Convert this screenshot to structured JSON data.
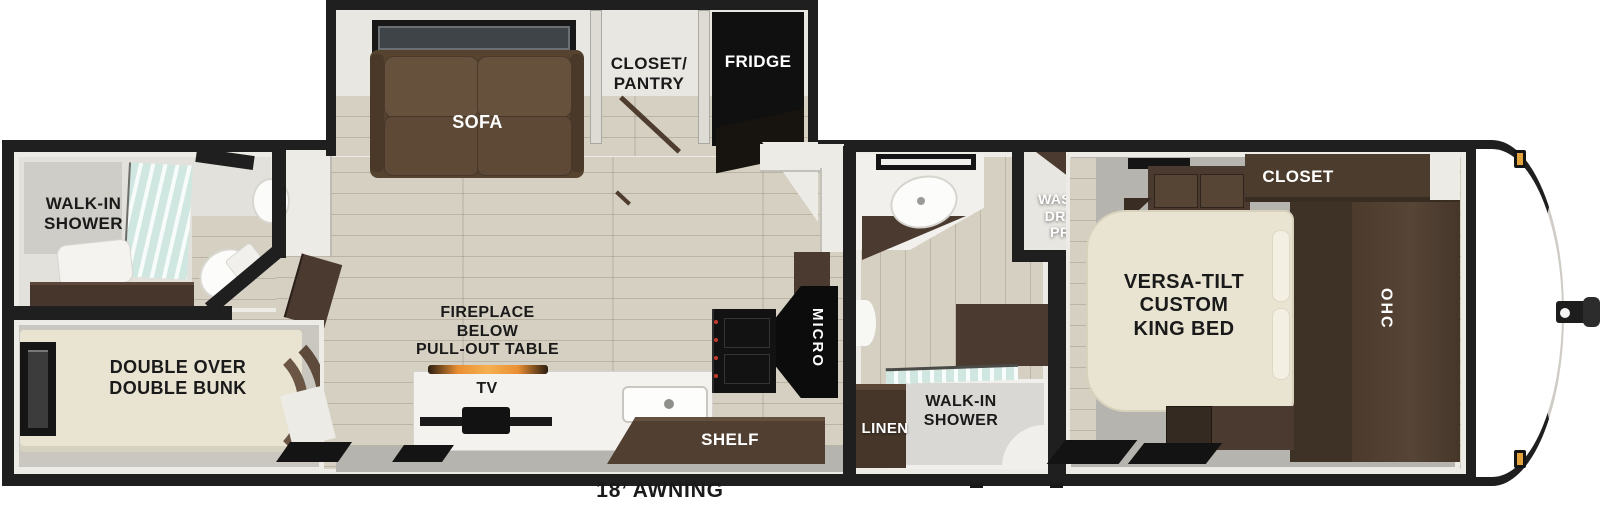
{
  "floorplan": {
    "awning_label": "18’ AWNING",
    "labels": {
      "rear_shower": "WALK-IN\nSHOWER",
      "bunk": "DOUBLE OVER\nDOUBLE BUNK",
      "sofa": "SOFA",
      "closet_pantry": "CLOSET/\nPANTRY",
      "fridge": "FRIDGE",
      "fireplace": "FIREPLACE\nBELOW\nPULL-OUT TABLE",
      "tv": "TV",
      "shelf": "SHELF",
      "micro": "MICRO",
      "washer_dryer": "WASHER\nDRYER\nPREP",
      "linen": "LINEN",
      "mid_shower": "WALK-IN\nSHOWER",
      "king_bed": "VERSA-TILT\nCUSTOM\nKING BED",
      "closet": "CLOSET",
      "ohc": "OHC"
    },
    "colors": {
      "wall": "#1f1f1f",
      "wall_face": "#ecebe5",
      "floor": "#d5d0c2",
      "floor_gray": "#b5b4ae",
      "cabinet_dark": "#4a3a2f",
      "cabinet_deep": "#382c23",
      "cabinet_mid": "#5d4a3a",
      "sofa_brown": "#55422f",
      "bed_cream": "#e9e4d2",
      "glass": "#cfe7e0",
      "appliance_black": "#101010",
      "marker_amber": "#e2a33c",
      "flame_orange": "#e98f33"
    }
  }
}
